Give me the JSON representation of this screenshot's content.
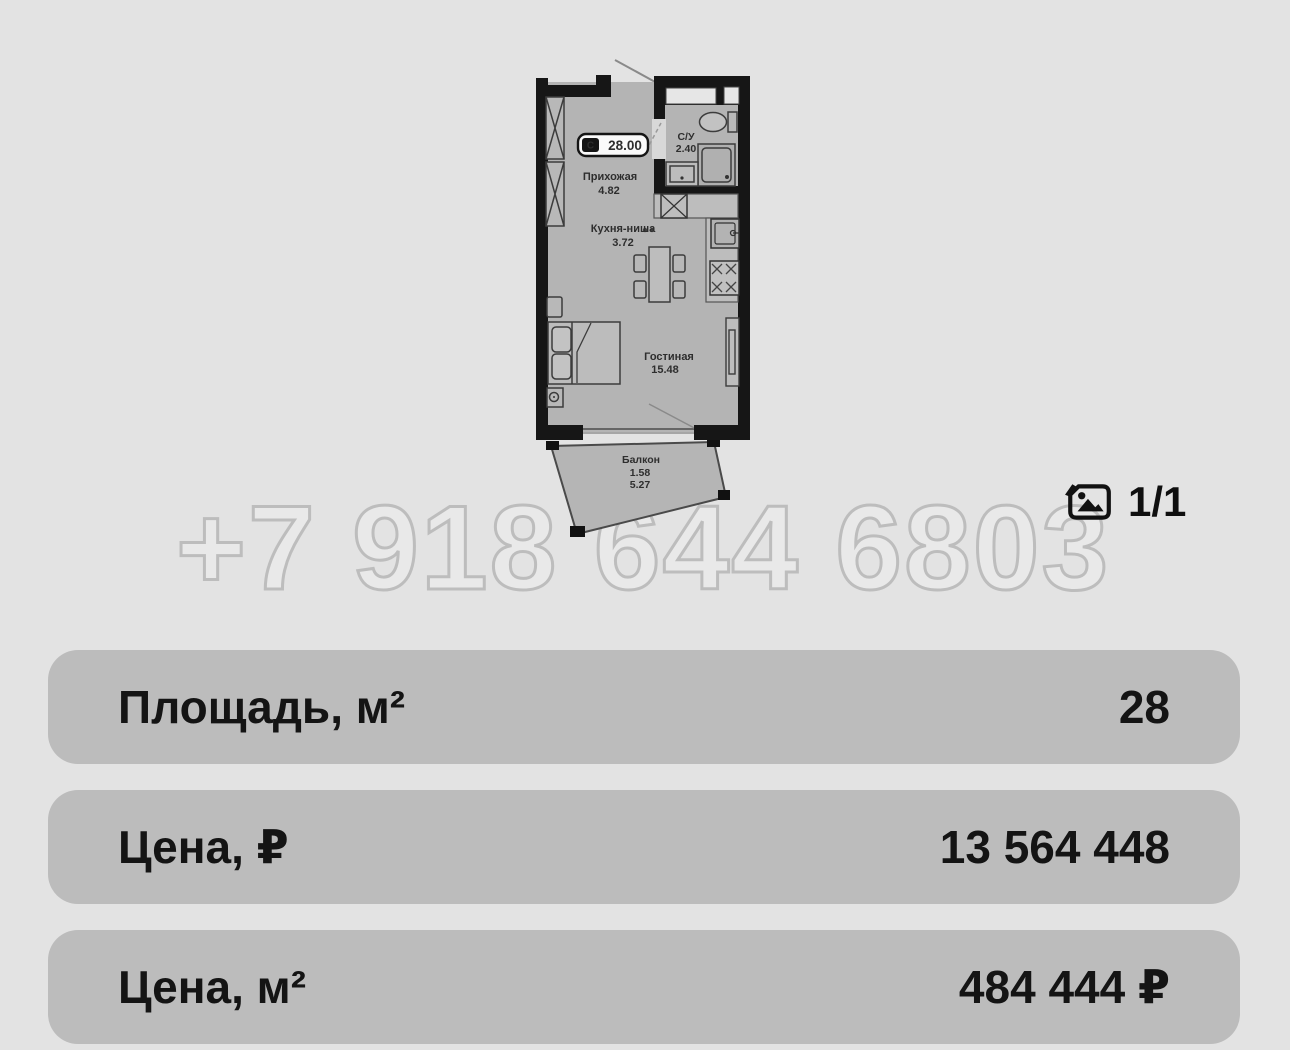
{
  "watermark": {
    "text": "+7 918 644 6803"
  },
  "gallery": {
    "counter": "1/1",
    "icon": "photos-icon"
  },
  "floorplan": {
    "badge": {
      "marker": "С",
      "total_area": "28.00"
    },
    "rooms": {
      "hallway": {
        "name": "Прихожая",
        "area": "4.82"
      },
      "bathroom": {
        "name": "С/У",
        "area": "2.40"
      },
      "kitchen": {
        "name": "Кухня-ниша",
        "area": "3.72"
      },
      "living": {
        "name": "Гостиная",
        "area": "15.48"
      },
      "balcony": {
        "name": "Балкон",
        "coef": "1.58",
        "area": "5.27"
      }
    }
  },
  "details": {
    "rows": [
      {
        "label": "Площадь, м²",
        "value": "28"
      },
      {
        "label": "Цена, ₽",
        "value": "13 564 448"
      },
      {
        "label": "Цена, м²",
        "value": "484 444 ₽"
      }
    ]
  },
  "colors": {
    "page_bg": "#e3e3e3",
    "row_bg": "#bcbcbc",
    "floor": "#b4b4b4",
    "wall": "#161616",
    "watermark_stroke": "#bdbdbd",
    "text": "#141414"
  }
}
